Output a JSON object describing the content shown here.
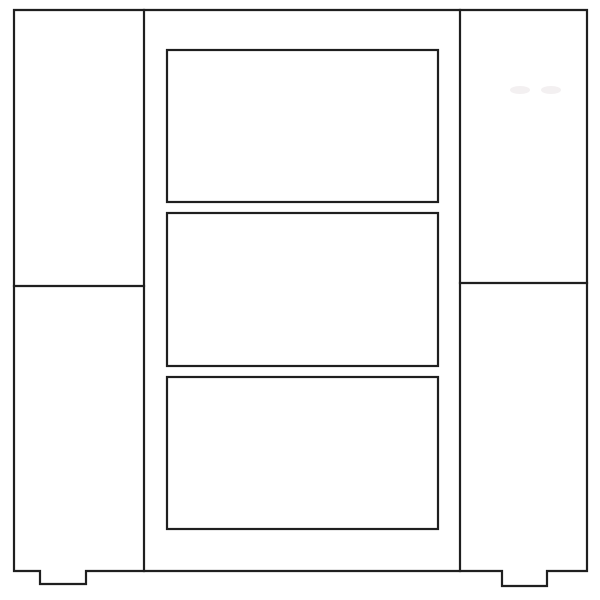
{
  "diagram": {
    "kind": "furniture-front-elevation-line-drawing",
    "subject": "cabinet with two side door panels, three center drawers and two feet",
    "canvas": {
      "width": 600,
      "height": 600,
      "background": "#ffffff"
    },
    "style": {
      "stroke": "#1f1f1f",
      "stroke_width": 2.2,
      "fill": "none"
    },
    "outline": {
      "name": "cabinet-body-outline-with-feet",
      "points": [
        [
          14,
          10
        ],
        [
          587,
          10
        ],
        [
          587,
          571
        ],
        [
          547,
          571
        ],
        [
          547,
          586
        ],
        [
          502,
          586
        ],
        [
          502,
          571
        ],
        [
          86,
          571
        ],
        [
          86,
          584
        ],
        [
          40,
          584
        ],
        [
          40,
          571
        ],
        [
          14,
          571
        ]
      ]
    },
    "lines": [
      {
        "name": "left-stile-line",
        "x1": 144,
        "y1": 10,
        "x2": 144,
        "y2": 571
      },
      {
        "name": "right-stile-line",
        "x1": 460,
        "y1": 10,
        "x2": 460,
        "y2": 571
      },
      {
        "name": "left-panel-rail-line",
        "x1": 14,
        "y1": 286,
        "x2": 144,
        "y2": 286
      },
      {
        "name": "right-panel-rail-line",
        "x1": 460,
        "y1": 283,
        "x2": 587,
        "y2": 283
      }
    ],
    "rects": [
      {
        "name": "top-drawer-panel",
        "x": 167,
        "y": 50,
        "width": 271,
        "height": 152
      },
      {
        "name": "middle-drawer-panel",
        "x": 167,
        "y": 213,
        "width": 271,
        "height": 153
      },
      {
        "name": "bottom-drawer-panel",
        "x": 167,
        "y": 377,
        "width": 271,
        "height": 152
      }
    ],
    "artifacts": [
      {
        "name": "scan-smudge",
        "cx": 520,
        "cy": 90,
        "rx": 10,
        "ry": 4,
        "color": "#f3f0f1"
      },
      {
        "name": "scan-smudge",
        "cx": 551,
        "cy": 90,
        "rx": 10,
        "ry": 4,
        "color": "#f3f0f1"
      }
    ]
  }
}
